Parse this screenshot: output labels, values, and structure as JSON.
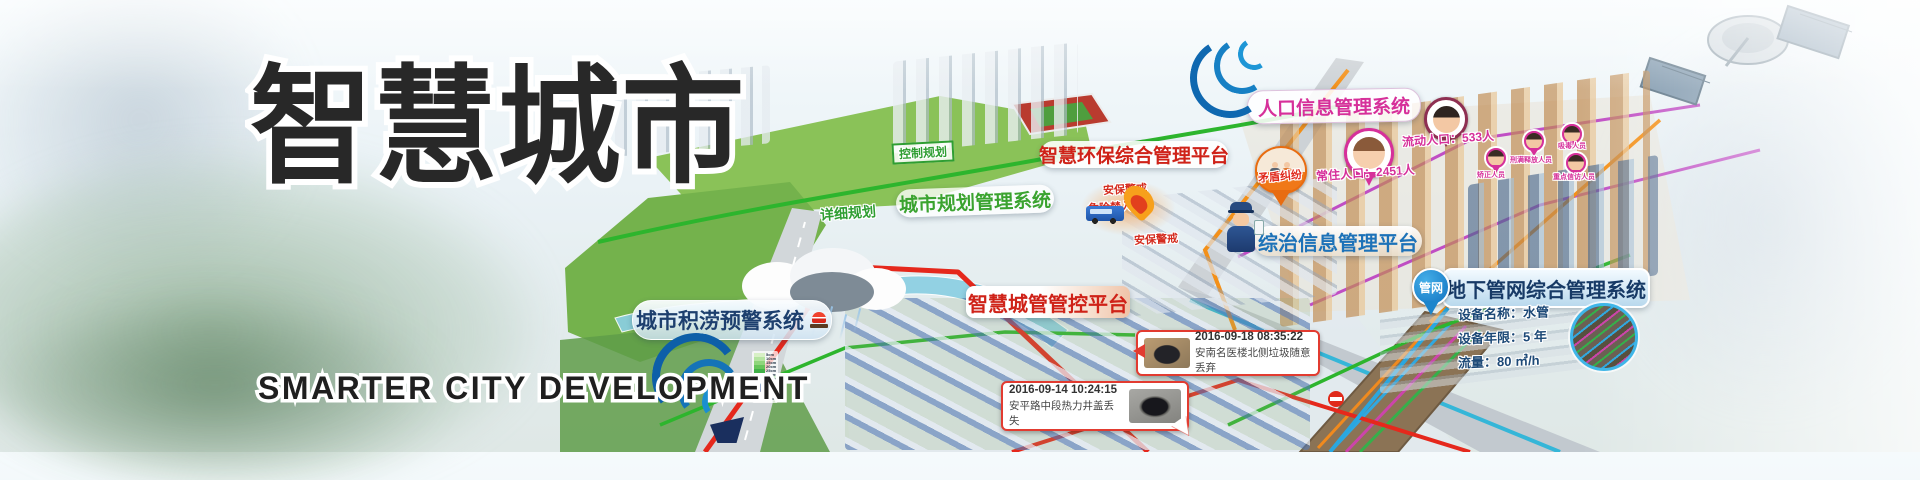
{
  "hero": {
    "title_cn": "智慧城市",
    "title_en": "SMARTER CITY DEVELOPMENT"
  },
  "systems": {
    "flood_warning": "城市积涝预警系统",
    "env_platform": "智慧环保综合管理平台",
    "planning_system": "城市规划管理系统",
    "planning_control": "控制规划",
    "planning_detail": "详细规划",
    "city_mgmt": "智慧城管管控平台",
    "zongzhi": "综治信息管理平台",
    "population_system": "人口信息管理系统",
    "pipe_system": "地下管网综合管理系统",
    "pipe_pin": "管网"
  },
  "population": {
    "resident": "常住人口：2451人",
    "floating": "流动人口：533人",
    "dispute": "矛盾纠纷",
    "tags": [
      "矫正人员",
      "刑满释放人员",
      "吸毒人员",
      "重点信访人员"
    ]
  },
  "hazard": {
    "alert_top": "安保警戒",
    "no_entry": "危险禁入",
    "alert_bottom": "安保警戒"
  },
  "pipe_info": {
    "rows": [
      "设备名称：水管",
      "设备年限：5 年",
      "流量：80 ㎥/h"
    ]
  },
  "events": [
    {
      "time": "2016-09-18 08:35:22",
      "desc": "安南名医楼北侧垃圾随意丢弃"
    },
    {
      "time": "2016-09-14 10:24:15",
      "desc": "安平路中段热力井盖丢失"
    }
  ],
  "flood_legend": {
    "depths": [
      "5cm",
      "10cm",
      "15cm",
      "20cm",
      "25cm",
      "30cm",
      "35cm",
      "40cm",
      "45cm",
      "50cm",
      "55cm",
      "60cm"
    ],
    "colors": [
      "#d8f0c6",
      "#b5e4a1",
      "#8fd67c",
      "#66c55b",
      "#41b148",
      "#2a9b3d",
      "#1f8748",
      "#2f6fa6",
      "#2b4f97",
      "#233a85",
      "#6e3390",
      "#8c2f7e"
    ]
  },
  "colors": {
    "title": "#282828",
    "env_red": "#cf2218",
    "planning_green": "#3aa32f",
    "population_magenta": "#d6309a",
    "zongzhi_blue": "#1d72b8",
    "pipe_navy": "#173a66",
    "alert_red": "#d42b1e",
    "pipe_pin_blue": "#1272c0",
    "boundary_red": "#e5281c",
    "env_line_green": "#2db52d"
  }
}
